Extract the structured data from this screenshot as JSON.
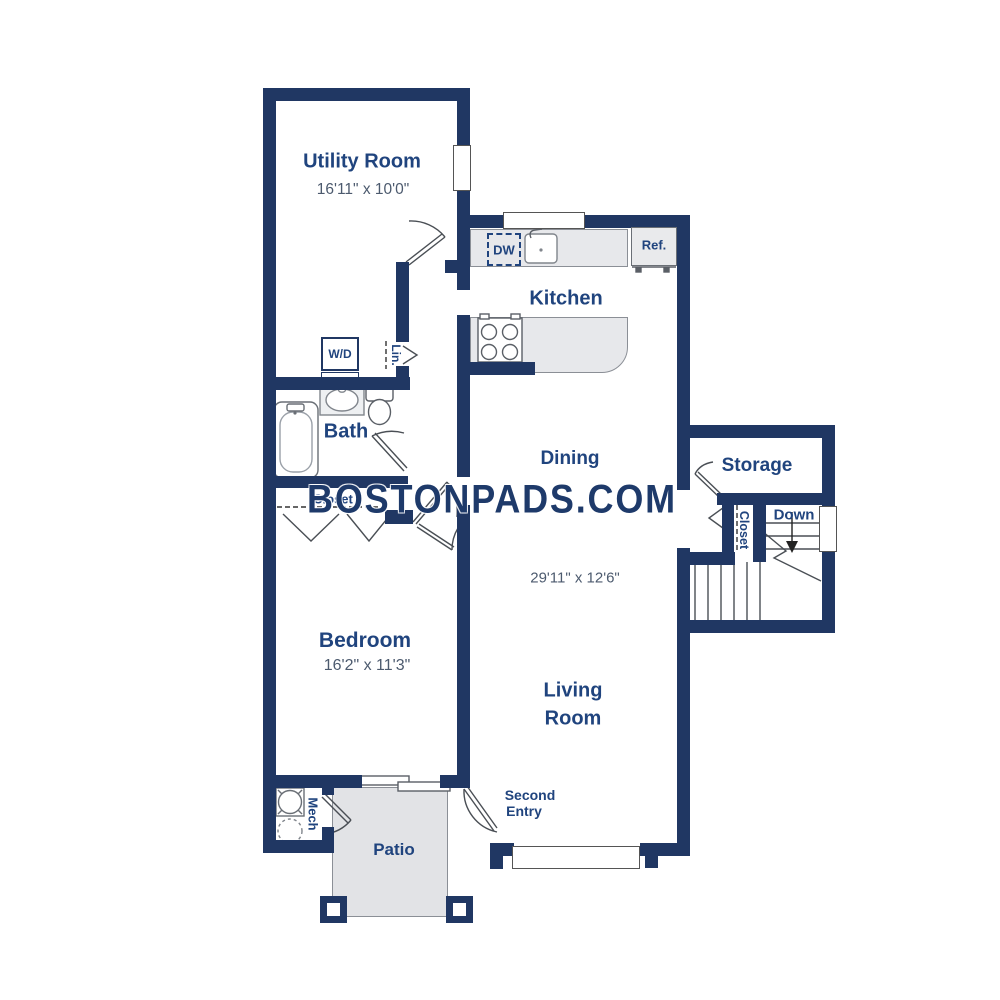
{
  "watermark": "BOSTONPADS.COM",
  "colors": {
    "wall": "#203763",
    "label": "#20447e",
    "dims": "#4c5a6e",
    "wm": "#1e3a6a",
    "counter": "#e7e8eb",
    "patio": "#e2e3e6"
  },
  "labels": {
    "utility_name": "Utility Room",
    "utility_dims": "16'11\" x 10'0\"",
    "kitchen": "Kitchen",
    "bath": "Bath",
    "dining": "Dining",
    "dining_dims": "29'11\" x 12'6\"",
    "storage": "Storage",
    "bedroom": "Bedroom",
    "bedroom_dims": "16'2\" x 11'3\"",
    "living_1": "Living",
    "living_2": "Room",
    "patio": "Patio",
    "mech": "Mech",
    "second_entry_1": "Second",
    "second_entry_2": "Entry",
    "down": "Down",
    "closet_stairs": "Closet",
    "closet_bedroom": "Closet",
    "lin": "Lin.",
    "wd": "W/D",
    "dw": "DW",
    "ref": "Ref."
  }
}
